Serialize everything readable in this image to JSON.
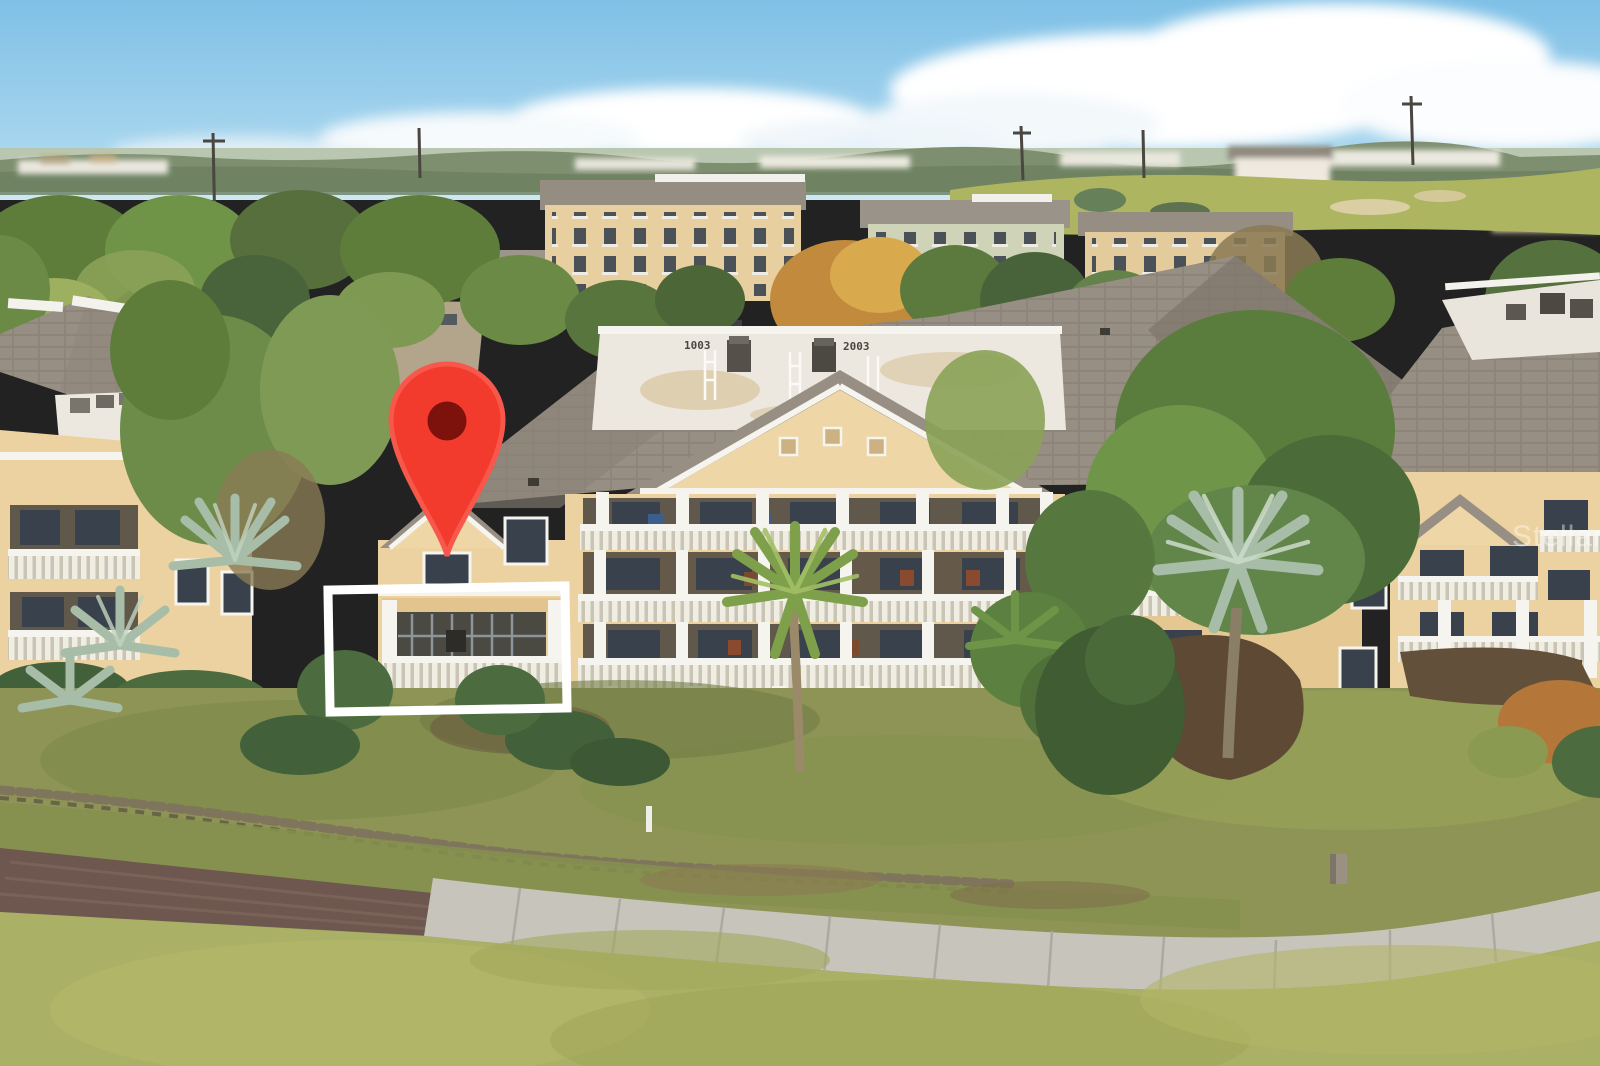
{
  "photo": {
    "kind": "aerial-drone-photo",
    "subject": "cream-colored multi-story resort condominium buildings beside a golf course, one unit marked for a real-estate listing",
    "sky_color": "#84c4e7",
    "horizon_color": "#cfe9f3"
  },
  "watermark": {
    "text": "StellarMLS",
    "color": "#ffffff",
    "opacity": "0.42"
  },
  "roof_markings": {
    "left": "1003",
    "right": "2003"
  },
  "overlays": {
    "map_pin": {
      "body_color": "#f23b2d",
      "rim_color": "#f8584c",
      "hole_color": "#7d120d",
      "tip_x": "447",
      "tip_y": "556"
    },
    "highlight_box": {
      "x": "329",
      "y": "588",
      "width": "237",
      "height": "122",
      "stroke": "#ffffff",
      "stroke_width": "9"
    }
  },
  "palette": {
    "roof_gray": "#97ððð",
    "roof_gray_main": "#978f83",
    "roof_gray_dark": "#837b6f",
    "white_roof_deck": "#ece7df",
    "wall_cream": "#ecd2a0",
    "trim_white": "#f6f4ee",
    "porch_shadow": "#60584a",
    "window_dark": "#39424c",
    "fairway_green": "#aab065",
    "rough_olive": "#8e9456",
    "dirt_path_brown": "#6d574e",
    "concrete_path": "#c6c4bb",
    "tree_green": "#5e7d3b",
    "autumn_orange": "#c28a3c",
    "palm_silver": "#a7bda7"
  }
}
